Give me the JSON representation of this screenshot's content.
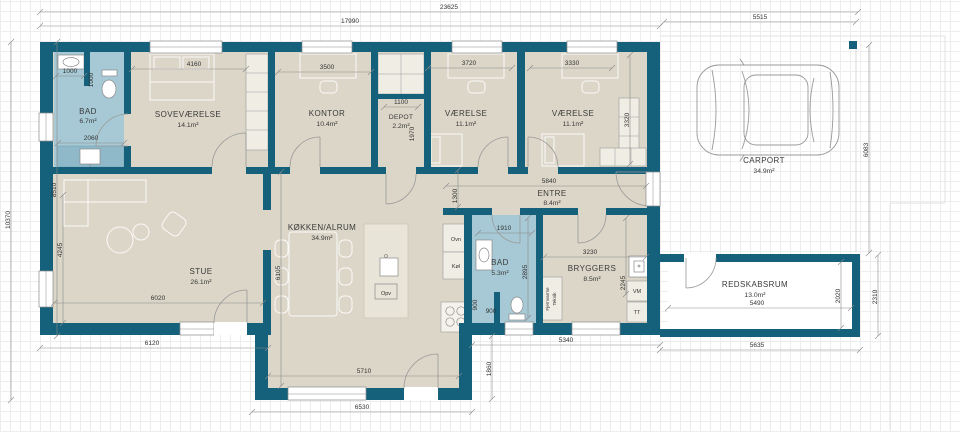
{
  "colors": {
    "wall": "#15617b",
    "floor": "#dbd6c8",
    "wet_room": "#a6c9d5",
    "shower": "#8fb9c8"
  },
  "rooms": {
    "bad1": {
      "name": "BAD",
      "area": "6.7m²"
    },
    "sovevaerelse": {
      "name": "SOVEVÆRELSE",
      "area": "14.1m²"
    },
    "kontor": {
      "name": "KONTOR",
      "area": "10.4m²"
    },
    "depot": {
      "name": "DEPOT",
      "area": "2.2m²"
    },
    "vaerelse1": {
      "name": "VÆRELSE",
      "area": "11.1m²"
    },
    "vaerelse2": {
      "name": "VÆRELSE",
      "area": "11.1m²"
    },
    "entre": {
      "name": "ENTRE",
      "area": "8.4m²"
    },
    "stue": {
      "name": "STUE",
      "area": "26.1m²"
    },
    "kokken": {
      "name": "KØKKEN/ALRUM",
      "area": "34.9m²"
    },
    "bad2": {
      "name": "BAD",
      "area": "5.3m²"
    },
    "bryggers": {
      "name": "BRYGGERS",
      "area": "8.5m²"
    },
    "redskabsrum": {
      "name": "REDSKABSRUM",
      "area": "13.0m²"
    },
    "carport": {
      "name": "CARPORT",
      "area": "34.9m²"
    }
  },
  "dims": {
    "total_width": "23625",
    "house_width": "17990",
    "carport_width": "5515",
    "total_depth": "10370",
    "house_depth": "8510",
    "stue_h": "4245",
    "stue_w": "6020",
    "stue_out_w": "6120",
    "bad1_niche_w": "1000",
    "bad1_niche_h": "1000",
    "bad1_shower_w": "2060",
    "sovevaerelse_w": "4160",
    "kontor_w": "3500",
    "depot_w": "1100",
    "depot_h": "1970",
    "vaerelse1_w": "3720",
    "vaerelse2_w": "3330",
    "vaerelse2_h": "3320",
    "entre_w": "5840",
    "hall_opening": "1300",
    "bad2_w": "1910",
    "bad2_h": "2895",
    "bad2_niche_w": "900",
    "bad2_niche_h": "900",
    "bryggers_w": "3230",
    "bryggers_h": "2245",
    "kokken_h": "6105",
    "kokken_w": "5710",
    "kokken_out_w": "6530",
    "kokken_ext": "1860",
    "south_mid_w": "5340",
    "carport_depth": "6083",
    "redskab_w": "5490",
    "redskab_h": "2020",
    "redskab_out_h": "2310",
    "redskab_out_w": "5635"
  },
  "labels": {
    "ovn": "Ovn",
    "kol": "Køl",
    "opv": "Opv",
    "vm": "VM",
    "tt": "TT",
    "fjernvarme": "Fjernvarme",
    "teknik": "Teknik"
  }
}
